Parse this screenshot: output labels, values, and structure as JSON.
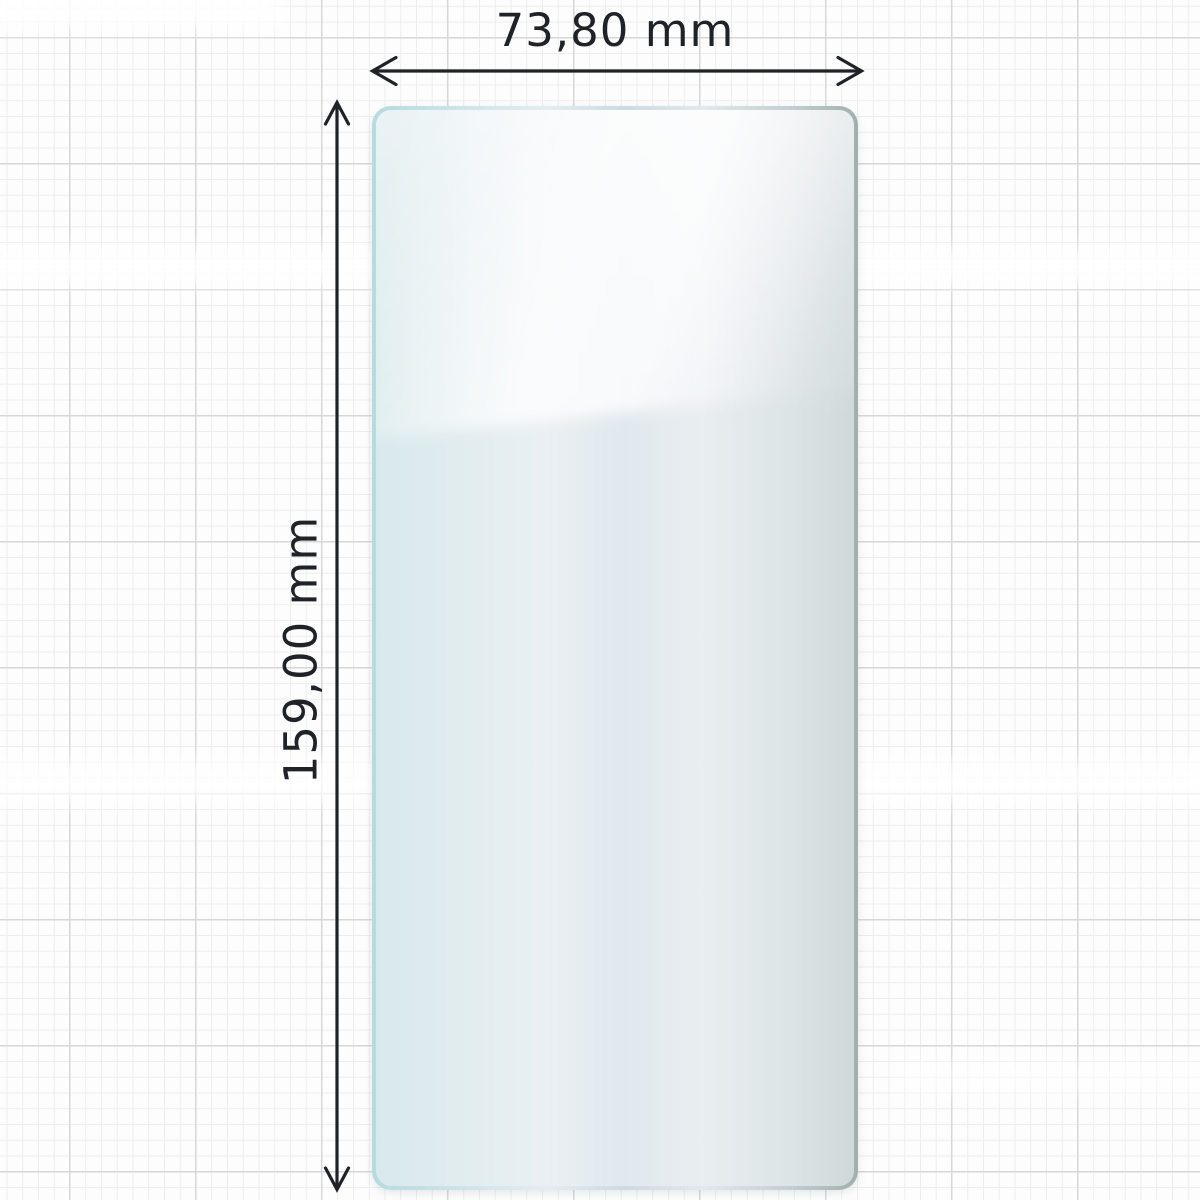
{
  "diagram": {
    "type": "product-dimension-diagram",
    "object": "smartphone-screen-protector-film",
    "background": "graph-paper-grid",
    "width_dimension": {
      "label": "73,80 mm",
      "value_mm": 73.8,
      "orientation": "horizontal",
      "arrow_style": "double-headed-open-chevron"
    },
    "height_dimension": {
      "label": "159,00 mm",
      "value_mm": 159.0,
      "orientation": "vertical",
      "arrow_style": "double-headed-open-chevron"
    },
    "colors": {
      "dimension_ink": "#1f2226",
      "glass_edge_teal": "#b5dbe0",
      "glass_edge_silver": "#d4dfe8",
      "glass_edge_gray_green": "#9fb0ad",
      "glass_fill": "rgba(238,241,243,0.60)",
      "grid_minor": "#ededee",
      "grid_major": "#d7d7d9",
      "paper": "#fdfdfd"
    }
  }
}
